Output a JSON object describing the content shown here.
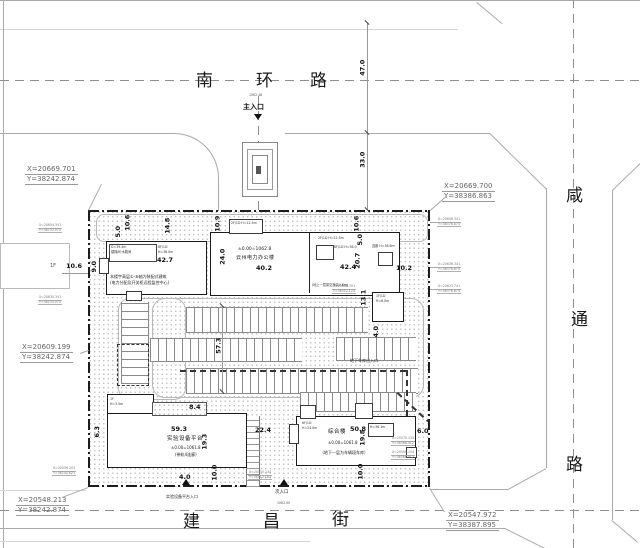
{
  "colors": {
    "building_outline": "#1b1b1b",
    "boundary_line": "#1d1d1d",
    "road_line": "#aaaaaa",
    "text": "#111111"
  },
  "roads": {
    "north": [
      "南",
      "环",
      "路"
    ],
    "east": [
      "咸",
      "通",
      "路"
    ],
    "south": [
      "建",
      "昌",
      "街"
    ]
  },
  "coords": {
    "tl_x": "X=20669.701",
    "tl_y": "Y=38242.874",
    "tr_x": "X=20669.700",
    "tr_y": "Y=38386.863",
    "ml_x": "X=20609.199",
    "ml_y": "Y=38242.874",
    "bl_x": "X=20548.213",
    "bl_y": "Y=38242.874",
    "br_x": "X=20547.972",
    "br_y": "Y=38387.895"
  },
  "micro": {
    "m1x": "X=20656.341",
    "m1y": "Y=38376.874",
    "m2x": "X=20636.341",
    "m2y": "Y=38376.874",
    "m3x": "X=20623.741",
    "m3y": "Y=38376.874",
    "m4x": "X=20654.341",
    "m4y": "Y=38233.074",
    "m5x": "X=20630.341",
    "m5y": "Y=38233.074",
    "m6x": "X=20556.203",
    "m6y": "Y=38244.623",
    "m7x": "X=20555.134",
    "m7y": "Y=38313.184",
    "m8x": "X=20570.134",
    "m8y": "Y=38368.412",
    "m9x": "X=20556.134",
    "m9y": "Y=38368.412",
    "m10x": "X=20608.701",
    "m10y": "Y=38352.124"
  },
  "entrances": {
    "main": "主入口",
    "main_elev": "1062.48",
    "secondary": "次入口",
    "secondary_elev": "1062.00",
    "platform": "实验设备平台入口",
    "garage": "地下车库出入口"
  },
  "buildings": {
    "office": {
      "name": "云州电力办公楼",
      "elev": "±0.00=1062.8",
      "note": "(地上一层架空净高4.6m)",
      "roof_label": "2F/1D H=12.5m",
      "roof_label2": "2F/1D H=12.5m",
      "stair_label": "8F/1D H=36.0",
      "corridor": "连廊 H=36.6m"
    },
    "west": {
      "tag_a1": "D=39.4m",
      "tag_a2": "楼梯间·水箱间",
      "tag_b1": "8F/1D",
      "tag_b2": "H=36.0m",
      "note1": "本楼宇高层①-⑧轴为装配式建筑",
      "note2": "(电力分配及开关柜远程监控中心)"
    },
    "platform": {
      "name": "实验设备平台",
      "elev": "±0.00=1061.8",
      "note": "(带轨4连廊)",
      "floor1": "1F",
      "floor2": "H=3.5m"
    },
    "complex": {
      "name": "综合楼",
      "elev": "±0.00=1061.8",
      "note": "（地下一层为车辆段车库）",
      "floor1": "6F/1D",
      "floor2": "H=24.0m",
      "roof": "H=36.1m"
    },
    "kiosk1": "1F/1D",
    "kiosk2": "H=6.0m"
  },
  "adjacent": {
    "west_label": "1F"
  },
  "dims": {
    "d47": "47.0",
    "d33": "33.0",
    "d573": "57.3",
    "d240": "24.0",
    "d148": "14.8",
    "d109": "10.9",
    "d50a": "5.0",
    "d106a": "10.6",
    "d50b": "5.0",
    "d106b": "10.6",
    "d106w": "10.6",
    "d90": "9.0",
    "d427": "42.7",
    "d402": "40.2",
    "d424": "42.4",
    "d207": "20.7",
    "d102": "10.2",
    "d131": "13.1",
    "d40r": "4.0",
    "d593": "59.3",
    "d193": "19.3",
    "d84": "8.4",
    "d63": "6.3",
    "d224": "22.4",
    "d40b": "4.0",
    "d100b": "10.0",
    "d508": "50.8",
    "d198": "19.8",
    "d60": "6.0",
    "d100c": "10.0"
  }
}
